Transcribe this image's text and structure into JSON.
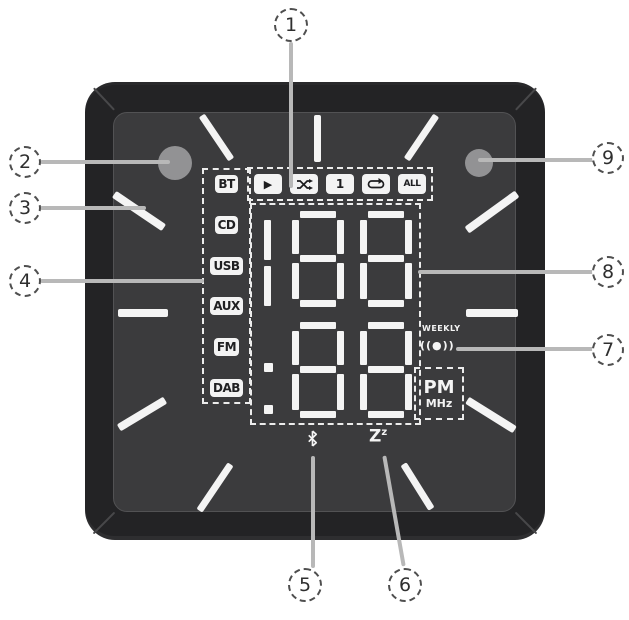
{
  "diagram": {
    "type": "clock-radio display callout diagram"
  },
  "callouts": [
    "1",
    "2",
    "3",
    "4",
    "5",
    "6",
    "7",
    "8",
    "9"
  ],
  "sources": [
    "BT",
    "CD",
    "USB",
    "AUX",
    "FM",
    "DAB"
  ],
  "playback": {
    "play": "▶",
    "repeat_one": "1",
    "repeat_all": "ALL"
  },
  "display": {
    "top_digits": "188",
    "bottom_digits": "88",
    "weekly": "WEEKLY",
    "alarm_icon": "((●))",
    "pm": "PM",
    "mhz": "MHz",
    "sleep_main": "Z",
    "sleep_sup": "z"
  },
  "colors": {
    "bezel": "#232325",
    "face": "#3b3b3d",
    "segment": "#f4f4f4",
    "leader": "#b8b8b8",
    "sensor": "#929294"
  }
}
